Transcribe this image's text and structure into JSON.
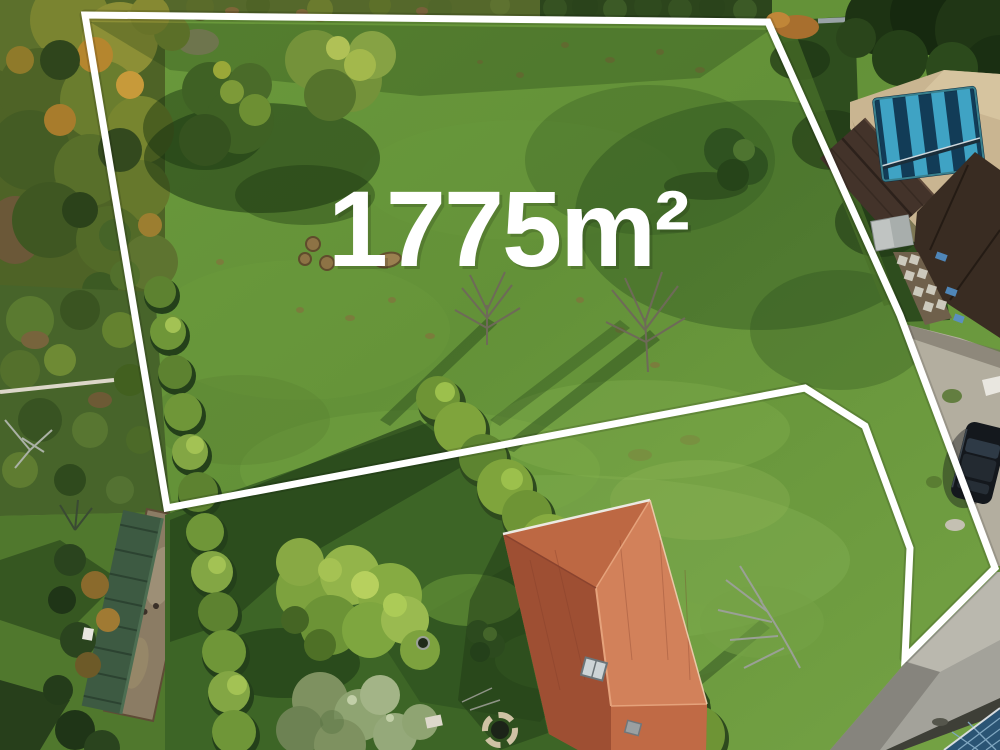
{
  "image": {
    "kind": "aerial-drone-photo",
    "description": "Aerial drone photo of a grassy building plot for sale, outlined with a white boundary polygon and labelled with its surface area. Neighbouring houses: covered swimming pool at top right, terracotta hip-roof house at bottom centre, green-roofed shed at bottom left, road and solar-panel roof at bottom right.",
    "width_px": 1000,
    "height_px": 750
  },
  "overlay": {
    "area_label": "1775m²",
    "label_color": "#ffffff",
    "boundary_color": "#ffffff",
    "boundary_stroke_px": 7,
    "boundary_points": "85,15 768,22 900,315 995,568 905,658 910,548 865,426 805,388 167,508"
  },
  "scene": {
    "meadow_color": "#669238",
    "meadow_sunlit_color": "#84b150",
    "shadow_color": "#1c3a12",
    "pool_cover_dark": "#123c57",
    "pool_cover_light": "#3fa3c4",
    "house_roof_color": "#c06a45",
    "neighbor_roof_color": "#392c22",
    "green_shed_roof_color": "#3d5a42",
    "hedge_color": "#6e9435",
    "road_color": "#a3a29a",
    "solar_roof_color": "#2a5474",
    "car_color": "#14181d",
    "patio_color": "#c9b591",
    "gravel_color": "#b3ae9f"
  }
}
